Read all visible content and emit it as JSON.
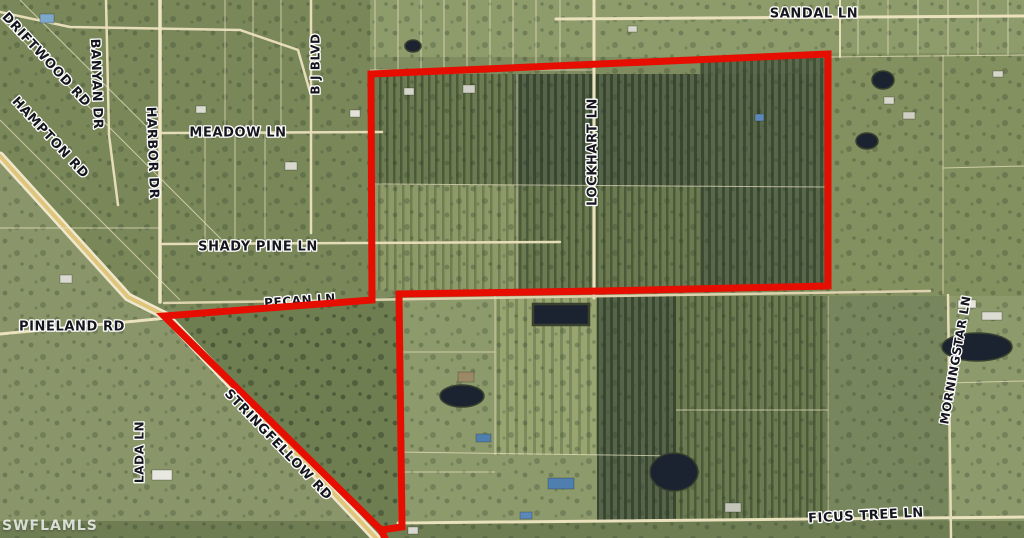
{
  "map": {
    "width": 1024,
    "height": 538,
    "watermark": {
      "text": "SWFLAMLS"
    },
    "boundary": {
      "color": "#e60e00",
      "stroke_width": 7,
      "points": "371,74 828,54 828,286 600,291 399,294 402,527 381,530 164,316 372,300 371,74",
      "tail": "381,530 394,557"
    },
    "street_labels": [
      {
        "text": "DRIFTWOOD RD",
        "x": 46,
        "y": 60,
        "rotate": 47,
        "size": 13,
        "layer": "over"
      },
      {
        "text": "BANYAN DR",
        "x": 96,
        "y": 84,
        "rotate": 88,
        "size": 13,
        "layer": "over"
      },
      {
        "text": "HAMPTON RD",
        "x": 50,
        "y": 138,
        "rotate": 47,
        "size": 13,
        "layer": "over"
      },
      {
        "text": "HARBOR DR",
        "x": 152,
        "y": 153,
        "rotate": 88,
        "size": 13,
        "layer": "over"
      },
      {
        "text": "B J BLVD",
        "x": 316,
        "y": 64,
        "rotate": -90,
        "size": 12,
        "layer": "over"
      },
      {
        "text": "MEADOW LN",
        "x": 238,
        "y": 133,
        "rotate": 0,
        "size": 13,
        "layer": "over"
      },
      {
        "text": "SANDAL LN",
        "x": 814,
        "y": 14,
        "rotate": 0,
        "size": 13,
        "layer": "over"
      },
      {
        "text": "SHADY PINE LN",
        "x": 258,
        "y": 247,
        "rotate": 0,
        "size": 13,
        "layer": "over"
      },
      {
        "text": "LOCKHART LN",
        "x": 593,
        "y": 152,
        "rotate": -90,
        "size": 13,
        "layer": "over"
      },
      {
        "text": "PECAN LN",
        "x": 300,
        "y": 301,
        "rotate": -4,
        "size": 12,
        "layer": "under"
      },
      {
        "text": "PINELAND RD",
        "x": 72,
        "y": 327,
        "rotate": 0,
        "size": 13,
        "layer": "over"
      },
      {
        "text": "LADA LN",
        "x": 140,
        "y": 452,
        "rotate": -90,
        "size": 12,
        "layer": "over"
      },
      {
        "text": "STRINGFELLOW RD",
        "x": 278,
        "y": 445,
        "rotate": 46,
        "size": 13,
        "layer": "over"
      },
      {
        "text": "MORNINGSTAR LN",
        "x": 956,
        "y": 360,
        "rotate": -80,
        "size": 12,
        "layer": "over"
      },
      {
        "text": "FICUS TREE LN",
        "x": 866,
        "y": 516,
        "rotate": -3,
        "size": 13,
        "layer": "over"
      }
    ],
    "roads": [
      {
        "name": "sandal-ln",
        "points": "556,19 1024,16",
        "width": 3,
        "color": "#eae1bd"
      },
      {
        "name": "top-left-connector",
        "points": "0,12 70,27 240,30 298,50 310,92",
        "width": 2.5,
        "color": "#e6ddb8"
      },
      {
        "name": "banyan-dr",
        "points": "106,0 109,135 118,205",
        "width": 2.5,
        "color": "#e6ddb8"
      },
      {
        "name": "harbor-dr",
        "points": "160,0 160,302",
        "width": 3.5,
        "color": "#ede5c4"
      },
      {
        "name": "b-j-blvd",
        "points": "311,0 311,233",
        "width": 2.5,
        "color": "#e6ddb8"
      },
      {
        "name": "lockhart-ln",
        "points": "594,0 594,298",
        "width": 3,
        "color": "#eae1bd"
      },
      {
        "name": "meadow-ln",
        "points": "162,133 382,132",
        "width": 2.5,
        "color": "#e6ddb8"
      },
      {
        "name": "shady-pine-ln",
        "points": "162,244 560,242",
        "width": 2.5,
        "color": "#e6ddb8"
      },
      {
        "name": "section-road",
        "points": "164,303 930,291",
        "width": 2.5,
        "color": "#ddd3ae"
      },
      {
        "name": "pineland-rd",
        "points": "0,334 167,318",
        "width": 3,
        "color": "#eae1bd"
      },
      {
        "name": "stringfellow-rd-shoulder",
        "points": "0,156 128,297 166,316 394,557",
        "width": 9,
        "color": "#efe8cd"
      },
      {
        "name": "stringfellow-rd",
        "points": "0,156 128,297 166,316 394,557",
        "width": 4,
        "color": "#dfc47c"
      },
      {
        "name": "ficus-tree-ln",
        "points": "398,523 1024,517",
        "width": 3,
        "color": "#eae1bd"
      },
      {
        "name": "morningstar-ln",
        "points": "948,295 951,538",
        "width": 2.5,
        "color": "#e6ddb8"
      },
      {
        "name": "top-spur",
        "points": "840,0 840,57",
        "width": 2,
        "color": "#e6ddb8"
      }
    ],
    "parcel_lines": [
      "375,0 375,70",
      "398,0 398,70",
      "421,0 421,70",
      "444,0 444,70",
      "467,0 467,70",
      "490,0 490,70",
      "513,0 513,70",
      "536,0 536,70",
      "560,0 560,70",
      "370,70 594,70",
      "858,0 858,55",
      "888,0 888,55",
      "918,0 918,55",
      "948,0 948,55",
      "978,0 978,55",
      "1008,0 1008,55",
      "828,57 1024,55",
      "943,55 943,294",
      "943,168 1024,166",
      "517,74 517,290",
      "372,184 828,187",
      "0,228 160,228",
      "225,0 225,133",
      "253,0 253,133",
      "281,0 281,133",
      "205,133 205,243",
      "235,133 235,243",
      "265,133 265,243",
      "495,296 495,455",
      "398,352 495,352",
      "398,452 676,456",
      "398,472 495,472",
      "676,410 828,410",
      "828,296 828,521",
      "948,383 1024,381",
      "0,18 230,248",
      "0,120 180,300",
      "20,0 150,130"
    ],
    "ponds": [
      {
        "shape": "ellipse",
        "cx": 883,
        "cy": 80,
        "rx": 11,
        "ry": 9
      },
      {
        "shape": "ellipse",
        "cx": 867,
        "cy": 141,
        "rx": 11,
        "ry": 8
      },
      {
        "shape": "rect",
        "x": 533,
        "y": 304,
        "w": 56,
        "h": 21
      },
      {
        "shape": "ellipse",
        "cx": 462,
        "cy": 396,
        "rx": 22,
        "ry": 11
      },
      {
        "shape": "ellipse",
        "cx": 674,
        "cy": 472,
        "rx": 24,
        "ry": 19
      },
      {
        "shape": "ellipse",
        "cx": 977,
        "cy": 347,
        "rx": 35,
        "ry": 14
      },
      {
        "shape": "ellipse",
        "cx": 413,
        "cy": 46,
        "rx": 8,
        "ry": 6
      }
    ],
    "structures": [
      {
        "x": 40,
        "y": 14,
        "w": 14,
        "h": 9,
        "color": "#7fa7c9"
      },
      {
        "x": 196,
        "y": 106,
        "w": 10,
        "h": 7,
        "color": "#dcdcd2"
      },
      {
        "x": 285,
        "y": 162,
        "w": 12,
        "h": 8,
        "color": "#d8d8cc"
      },
      {
        "x": 350,
        "y": 110,
        "w": 10,
        "h": 7,
        "color": "#e2e2d8"
      },
      {
        "x": 404,
        "y": 88,
        "w": 10,
        "h": 7,
        "color": "#d5d5c9"
      },
      {
        "x": 463,
        "y": 85,
        "w": 12,
        "h": 8,
        "color": "#cfcfc5"
      },
      {
        "x": 628,
        "y": 26,
        "w": 9,
        "h": 6,
        "color": "#d8d8cc"
      },
      {
        "x": 755,
        "y": 114,
        "w": 9,
        "h": 7,
        "color": "#5b88b8"
      },
      {
        "x": 884,
        "y": 97,
        "w": 10,
        "h": 7,
        "color": "#d8d8ce"
      },
      {
        "x": 903,
        "y": 112,
        "w": 12,
        "h": 7,
        "color": "#cfcfc3"
      },
      {
        "x": 993,
        "y": 71,
        "w": 10,
        "h": 6,
        "color": "#d6d6ca"
      },
      {
        "x": 958,
        "y": 300,
        "w": 18,
        "h": 8,
        "color": "#e5e5da"
      },
      {
        "x": 982,
        "y": 312,
        "w": 20,
        "h": 8,
        "color": "#dddcd2"
      },
      {
        "x": 152,
        "y": 470,
        "w": 20,
        "h": 10,
        "color": "#e8e8e0"
      },
      {
        "x": 60,
        "y": 275,
        "w": 12,
        "h": 8,
        "color": "#d9d9cf"
      },
      {
        "x": 458,
        "y": 372,
        "w": 16,
        "h": 10,
        "color": "#9b8864"
      },
      {
        "x": 476,
        "y": 434,
        "w": 15,
        "h": 8,
        "color": "#4f7fae"
      },
      {
        "x": 548,
        "y": 478,
        "w": 26,
        "h": 11,
        "color": "#4f7fae"
      },
      {
        "x": 520,
        "y": 512,
        "w": 12,
        "h": 7,
        "color": "#5b88b8"
      },
      {
        "x": 408,
        "y": 527,
        "w": 10,
        "h": 7,
        "color": "#d8d8d0"
      },
      {
        "x": 725,
        "y": 503,
        "w": 16,
        "h": 9,
        "color": "#c4c4b8"
      }
    ],
    "palette": {
      "pond": "#1b2330",
      "parcel_line": "#ece4c4",
      "label_fill": "#16161f",
      "label_halo": "#ffffff"
    }
  }
}
